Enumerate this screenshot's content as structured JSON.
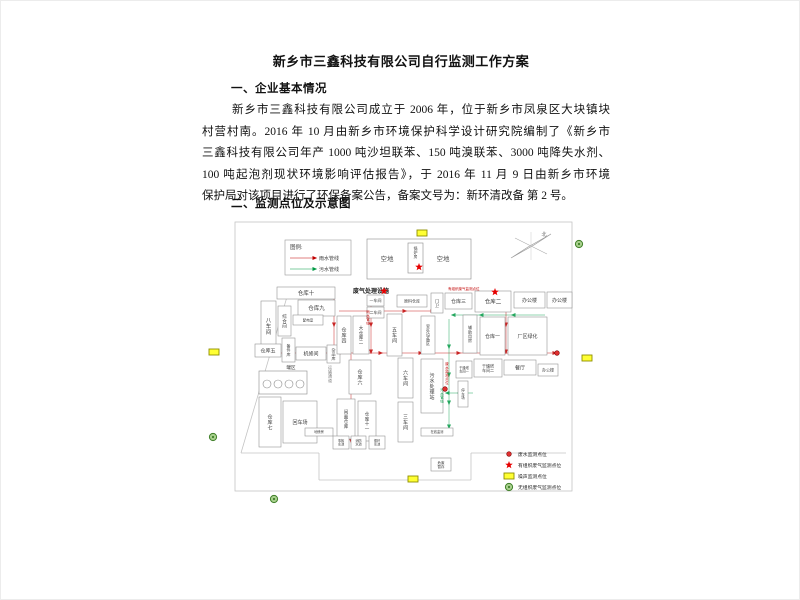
{
  "document": {
    "title": "新乡市三鑫科技有限公司自行监测工作方案",
    "section1_heading": "一、企业基本情况",
    "paragraph_lines": [
      "新乡市三鑫科技有限公司成立于 2006 年，位于新乡市凤泉区大块镇块",
      "村营村南。2016 年 10 月由新乡市环境保护科学设计研究院编制了《新乡市",
      "三鑫科技有限公司年产 1000 吨沙坦联苯、150 吨溴联苯、3000 吨降失水剂、",
      "100 吨起泡剂现状环境影响评估报告》，于 2016 年 11 月 9 日由新乡市环境",
      "保护局对该项目进行了环保备案公告，备案文号为：新环清改备 第 2 号。"
    ],
    "section2_heading": "二、监测点位及示意图"
  },
  "colors": {
    "rain": "#c00000",
    "sewage": "#009944",
    "noise_fill": "#ffff33",
    "noise_stroke": "#8f8f00",
    "star_fill": "#e60000",
    "fugitive_fill": "#a8d08d",
    "fugitive_stroke": "#3f7f28",
    "wastewater_fill": "#e03030",
    "wastewater_stroke": "#7a0000",
    "boundary": "#c4c4c4",
    "building_stroke": "#8a8a8a",
    "text": "#3a3a3a"
  },
  "diagram": {
    "legend_box": {
      "x": 284,
      "y": 239,
      "w": 66,
      "h": 35,
      "title": "图例:",
      "items": [
        {
          "label": "雨水管线",
          "color": "#c00000"
        },
        {
          "label": "污水管线",
          "color": "#009944"
        }
      ]
    },
    "marker_legend": {
      "x": 508,
      "y": 453,
      "row_gap": 11,
      "items": [
        {
          "type": "red-dot",
          "label": "废水监测点位"
        },
        {
          "type": "red-star",
          "label": "有组织废气监测点位"
        },
        {
          "type": "yellow-rect",
          "label": "噪声监测点位"
        },
        {
          "type": "green-circle",
          "label": "无组织废气监测点位"
        }
      ]
    },
    "compass": {
      "label": "北",
      "cx": 530,
      "cy": 245
    },
    "border": {
      "x1": 234,
      "y1": 221,
      "x2": 571,
      "y2": 490
    },
    "boundary_lines": [
      [
        [
          288,
          289
        ],
        [
          240,
          452
        ]
      ],
      [
        [
          240,
          452
        ],
        [
          318,
          452
        ]
      ],
      [
        [
          318,
          452
        ],
        [
          318,
          479
        ]
      ],
      [
        [
          318,
          479
        ],
        [
          470,
          479
        ]
      ],
      [
        [
          470,
          479
        ],
        [
          470,
          452
        ]
      ],
      [
        [
          470,
          452
        ],
        [
          565,
          452
        ]
      ]
    ],
    "open_area": {
      "rect": {
        "x": 366,
        "y": 238,
        "w": 104,
        "h": 40
      },
      "left_label": "空地",
      "right_label": "空地",
      "boiler": {
        "x": 407,
        "y": 242,
        "w": 15,
        "h": 30,
        "label": "锅炉房"
      }
    },
    "tank_area": {
      "x": 258,
      "y": 370,
      "w": 48,
      "h": 23,
      "label": "罐区"
    },
    "waste_gas_facility": {
      "label": "废气处理设施",
      "x": 352,
      "y": 292
    },
    "road_label": {
      "text": "运输通道",
      "x": 329,
      "y": 368
    },
    "pipe_text_labels": [
      {
        "text": "雨水管线",
        "color": "#c00000",
        "x": 367,
        "y": 312,
        "vertical": true
      },
      {
        "text": "废水监测点位",
        "color": "#c00000",
        "x": 446,
        "y": 364,
        "vertical": true
      },
      {
        "text": "污水管线",
        "color": "#009944",
        "x": 441,
        "y": 390,
        "vertical": true
      },
      {
        "text": "有组织废气监测点位",
        "color": "#c00000",
        "x": 447,
        "y": 289,
        "vertical": false
      }
    ],
    "buildings": [
      {
        "label": "仓库十",
        "x": 276,
        "y": 286,
        "w": 58,
        "h": 12,
        "fs": 5.5
      },
      {
        "label": "仓库九",
        "x": 297,
        "y": 299,
        "w": 37,
        "h": 16,
        "fs": 5.5
      },
      {
        "label": "八车间",
        "x": 260,
        "y": 300,
        "w": 15,
        "h": 50,
        "v": 1,
        "fs": 5.5
      },
      {
        "label": "综合间",
        "x": 277,
        "y": 305,
        "w": 13,
        "h": 30,
        "v": 1,
        "fs": 4.5
      },
      {
        "label": "配电室",
        "x": 292,
        "y": 314,
        "w": 30,
        "h": 10,
        "fs": 3.5
      },
      {
        "label": "仓库五",
        "x": 254,
        "y": 343,
        "w": 26,
        "h": 13,
        "fs": 5
      },
      {
        "label": "备件库",
        "x": 281,
        "y": 337,
        "w": 13,
        "h": 24,
        "v": 1,
        "fs": 4
      },
      {
        "label": "机修间",
        "x": 295,
        "y": 346,
        "w": 30,
        "h": 13,
        "fs": 5
      },
      {
        "label": "杂品库",
        "x": 326,
        "y": 344,
        "w": 13,
        "h": 18,
        "v": 1,
        "fs": 4
      },
      {
        "label": "仓库四",
        "x": 336,
        "y": 315,
        "w": 14,
        "h": 38,
        "v": 1,
        "fs": 5
      },
      {
        "label": "大仓库二",
        "x": 352,
        "y": 315,
        "w": 16,
        "h": 38,
        "v": 1,
        "fs": 4.5
      },
      {
        "label": "五车间",
        "x": 386,
        "y": 313,
        "w": 15,
        "h": 42,
        "v": 1,
        "fs": 5
      },
      {
        "label": "一车间",
        "x": 366,
        "y": 294,
        "w": 17,
        "h": 11,
        "fs": 4
      },
      {
        "label": "二车间",
        "x": 366,
        "y": 306,
        "w": 17,
        "h": 11,
        "fs": 4
      },
      {
        "label": "原料仓库",
        "x": 396,
        "y": 294,
        "w": 30,
        "h": 12,
        "fs": 4
      },
      {
        "label": "室外设备区",
        "x": 420,
        "y": 315,
        "w": 14,
        "h": 38,
        "v": 1,
        "fs": 4
      },
      {
        "label": "门卫",
        "x": 430,
        "y": 292,
        "w": 12,
        "h": 20,
        "v": 1,
        "fs": 4
      },
      {
        "label": "仓库三",
        "x": 444,
        "y": 292,
        "w": 27,
        "h": 16,
        "fs": 5
      },
      {
        "label": "仓库二",
        "x": 474,
        "y": 290,
        "w": 36,
        "h": 21,
        "fs": 5.5
      },
      {
        "label": "办公楼",
        "x": 513,
        "y": 291,
        "w": 31,
        "h": 16,
        "fs": 5
      },
      {
        "label": "办公楼",
        "x": 546,
        "y": 291,
        "w": 25,
        "h": 16,
        "fs": 5
      },
      {
        "label": "辅助用房",
        "x": 462,
        "y": 314,
        "w": 14,
        "h": 38,
        "v": 1,
        "fs": 4
      },
      {
        "label": "仓库一",
        "x": 479,
        "y": 316,
        "w": 25,
        "h": 38,
        "fs": 5
      },
      {
        "label": "厂区绿化",
        "x": 507,
        "y": 316,
        "w": 39,
        "h": 38,
        "fs": 5
      },
      {
        "label": "仓库六",
        "x": 348,
        "y": 359,
        "w": 22,
        "h": 34,
        "v": 1,
        "fs": 5
      },
      {
        "label": "六车间",
        "x": 397,
        "y": 357,
        "w": 15,
        "h": 40,
        "v": 1,
        "fs": 5
      },
      {
        "label": "三车间",
        "x": 397,
        "y": 401,
        "w": 15,
        "h": 40,
        "v": 1,
        "fs": 5
      },
      {
        "label": "污水处理站",
        "x": 420,
        "y": 358,
        "w": 22,
        "h": 54,
        "v": 1,
        "fs": 5
      },
      {
        "label": "仓库七",
        "x": 258,
        "y": 396,
        "w": 22,
        "h": 50,
        "v": 1,
        "fs": 5
      },
      {
        "label": "回车场",
        "x": 282,
        "y": 400,
        "w": 34,
        "h": 42,
        "fs": 5
      },
      {
        "label": "闲置仓库",
        "x": 336,
        "y": 398,
        "w": 18,
        "h": 40,
        "v": 1,
        "fs": 4.5
      },
      {
        "label": "仓库十一",
        "x": 357,
        "y": 400,
        "w": 18,
        "h": 40,
        "v": 1,
        "fs": 4.5
      },
      {
        "label": "干燥塔车间一",
        "x": 455,
        "y": 360,
        "w": 16,
        "h": 17,
        "fs": 3.2,
        "wrap": 1
      },
      {
        "label": "干燥塔车间二",
        "x": 473,
        "y": 358,
        "w": 28,
        "h": 18,
        "fs": 4,
        "wrap": 1
      },
      {
        "label": "餐厅",
        "x": 503,
        "y": 359,
        "w": 32,
        "h": 15,
        "fs": 5
      },
      {
        "label": "办公楼",
        "x": 537,
        "y": 363,
        "w": 20,
        "h": 12,
        "fs": 4
      },
      {
        "label": "停车场",
        "x": 457,
        "y": 380,
        "w": 10,
        "h": 26,
        "v": 1,
        "fs": 3.5
      },
      {
        "label": "地磅房",
        "x": 304,
        "y": 427,
        "w": 28,
        "h": 8,
        "fs": 3.2
      },
      {
        "label": "事故水池",
        "x": 332,
        "y": 435,
        "w": 16,
        "h": 13,
        "fs": 3.2,
        "wrap": 1
      },
      {
        "label": "消防水池",
        "x": 350,
        "y": 435,
        "w": 15,
        "h": 13,
        "fs": 3.2,
        "wrap": 1
      },
      {
        "label": "循环水池",
        "x": 368,
        "y": 435,
        "w": 16,
        "h": 13,
        "fs": 3.2,
        "wrap": 1
      },
      {
        "label": "在线监测",
        "x": 420,
        "y": 427,
        "w": 32,
        "h": 8,
        "fs": 3.2
      },
      {
        "label": "危废暂存",
        "x": 430,
        "y": 457,
        "w": 20,
        "h": 13,
        "fs": 3.5,
        "wrap": 1
      }
    ],
    "pipes": [
      {
        "kind": "rain",
        "points": [
          [
            260,
            352
          ],
          [
            300,
            352
          ],
          [
            340,
            352
          ],
          [
            380,
            352
          ],
          [
            420,
            352
          ],
          [
            458,
            352
          ],
          [
            498,
            352
          ],
          [
            536,
            352
          ],
          [
            554,
            352
          ]
        ]
      },
      {
        "kind": "rain",
        "points": [
          [
            333,
            297
          ],
          [
            333,
            324
          ],
          [
            333,
            351
          ]
        ]
      },
      {
        "kind": "rain",
        "points": [
          [
            370,
            297
          ],
          [
            370,
            324
          ],
          [
            370,
            351
          ]
        ]
      },
      {
        "kind": "rain",
        "points": [
          [
            350,
            353
          ],
          [
            350,
            382
          ],
          [
            350,
            412
          ],
          [
            350,
            440
          ]
        ]
      },
      {
        "kind": "rain",
        "points": [
          [
            505,
            297
          ],
          [
            505,
            324
          ],
          [
            505,
            351
          ]
        ]
      },
      {
        "kind": "rain",
        "points": [
          [
            338,
            310
          ],
          [
            372,
            310
          ],
          [
            404,
            310
          ],
          [
            432,
            310
          ]
        ]
      },
      {
        "kind": "sewage",
        "points": [
          [
            448,
            318
          ],
          [
            448,
            346
          ],
          [
            448,
            374
          ],
          [
            448,
            402
          ],
          [
            448,
            426
          ]
        ]
      },
      {
        "kind": "sewage",
        "points": [
          [
            544,
            314
          ],
          [
            512,
            314
          ],
          [
            480,
            314
          ],
          [
            452,
            314
          ]
        ]
      },
      {
        "kind": "sewage",
        "points": [
          [
            472,
            392
          ],
          [
            458,
            392
          ],
          [
            446,
            392
          ]
        ]
      }
    ],
    "monitor_points": [
      {
        "type": "yellow-rect",
        "x": 421,
        "y": 232
      },
      {
        "type": "yellow-rect",
        "x": 213,
        "y": 351
      },
      {
        "type": "yellow-rect",
        "x": 586,
        "y": 357
      },
      {
        "type": "yellow-rect",
        "x": 412,
        "y": 478
      },
      {
        "type": "green-circle",
        "x": 578,
        "y": 243
      },
      {
        "type": "green-circle",
        "x": 212,
        "y": 436
      },
      {
        "type": "green-circle",
        "x": 273,
        "y": 498
      },
      {
        "type": "red-star",
        "x": 418,
        "y": 266
      },
      {
        "type": "red-star",
        "x": 383,
        "y": 290
      },
      {
        "type": "red-star",
        "x": 494,
        "y": 291
      },
      {
        "type": "red-dot",
        "x": 556,
        "y": 352
      },
      {
        "type": "red-dot",
        "x": 444,
        "y": 388
      }
    ]
  }
}
